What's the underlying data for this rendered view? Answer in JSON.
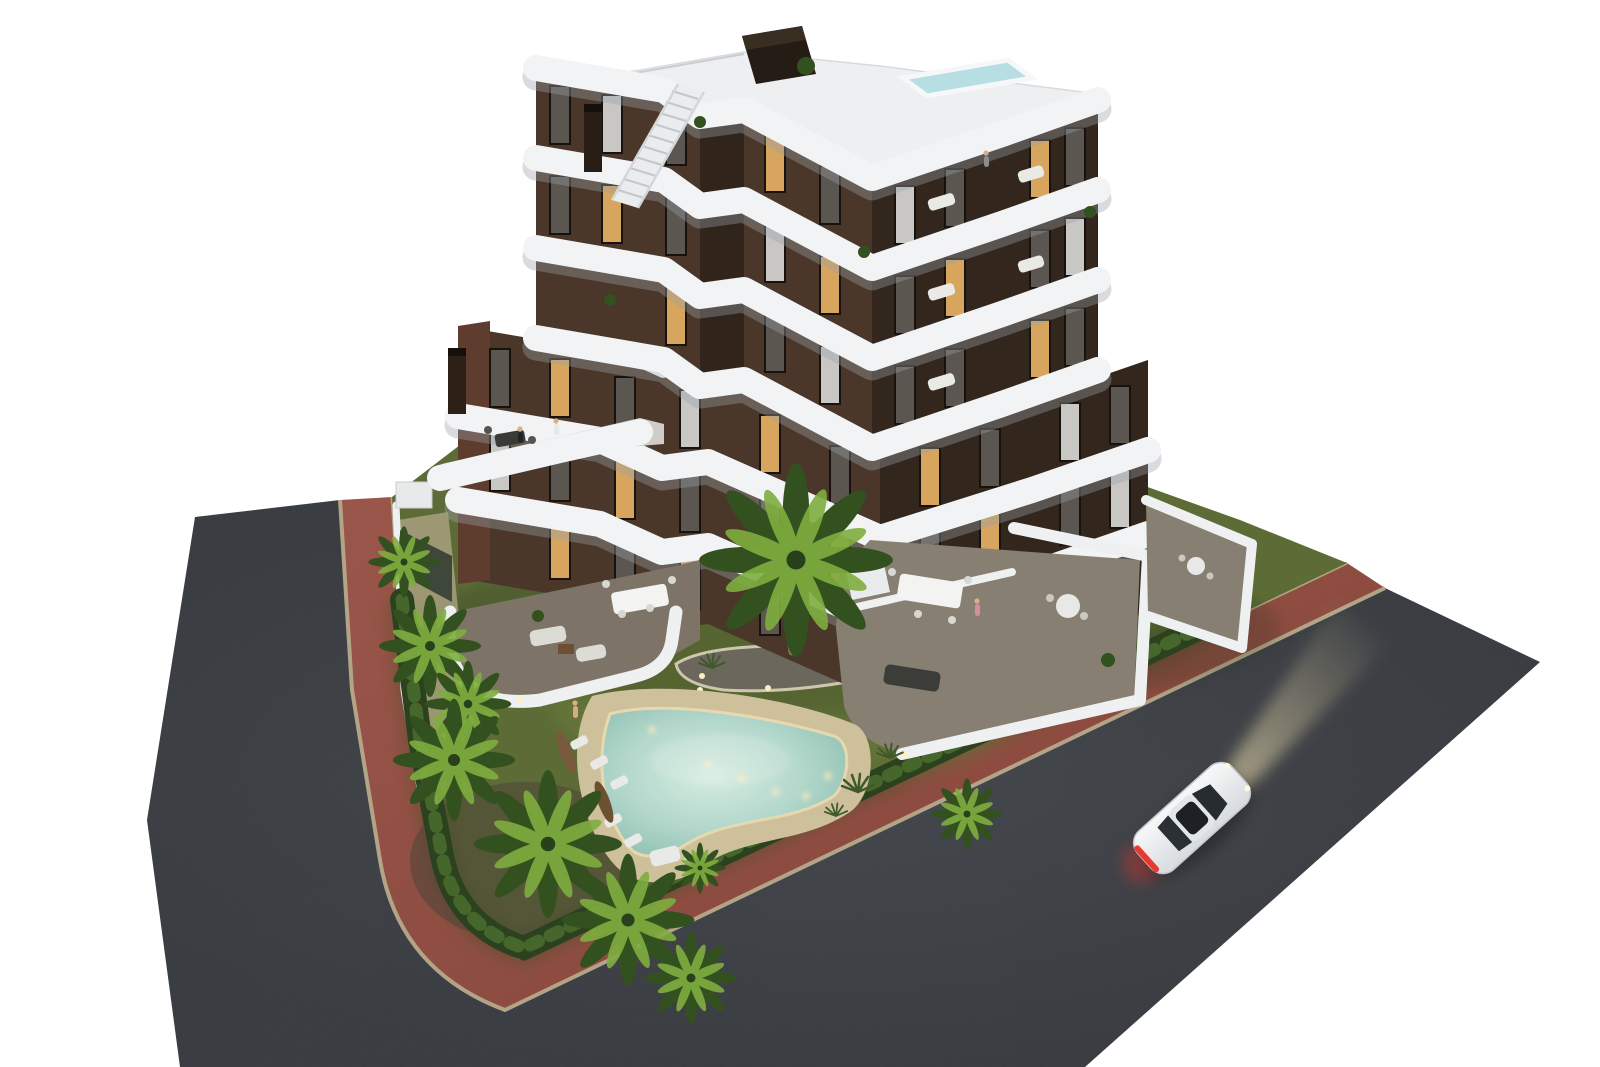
{
  "scene": {
    "title": "Aerial dusk 3D render of a new-build apartment complex with curved white balconies, rooftop pool, palm garden, free-form swimming pool and a white car on the surrounding street",
    "style": "photorealistic architectural visualization isolated on white",
    "view": "aerial three-quarter corner view",
    "time_of_day": "dusk",
    "background": "#ffffff"
  },
  "colors": {
    "bg": "#ffffff",
    "road": "#34373c",
    "road_light": "#474b52",
    "sidewalk": "#955044",
    "sidewalk_dark": "#7a4138",
    "curb": "#b3a488",
    "lawn": "#5d6c36",
    "lawn_dark": "#46552c",
    "hedge": "#2c421f",
    "hedge_light": "#4e7030",
    "gravel": "#b3a58a",
    "mulch": "#4e4639",
    "sand": "#cfc09c",
    "sand_rim": "#e6d9b0",
    "pool_water": "#a9d2c6",
    "pool_water_light": "#d6ece1",
    "pool_light": "#ffefc0",
    "facade_left": "#4a3729",
    "facade_right": "#332820",
    "facade_accent": "#5f3d2e",
    "band_white": "#f2f3f5",
    "roof_white": "#edeff1",
    "roof_pool": "#b7dee2",
    "terrace_floor": "#7d7467",
    "terrace_floor_right": "#878072",
    "wall_white": "#eff0f2",
    "window_glass": "#5b564f",
    "window_lit": "#d8a55e",
    "curtain": "#c9c7c3",
    "furniture_white": "#e9e9e5",
    "furniture_dark": "#3a3a36",
    "wood": "#7a5a3c",
    "umbrella": "#7a5a3c",
    "palm_dark": "#33511f",
    "palm_light": "#7fae3f",
    "trunk": "#8a7358",
    "car_body": "#eef0f2",
    "car_glass": "#272c31",
    "taillight": "#e8392f",
    "beam": "#f2e3b0"
  },
  "counts": {
    "balcony_bands": 6,
    "rooftop_pools": 1,
    "garden_pools": 1,
    "sun_loungers": 6,
    "closed_parasols": 2,
    "palm_trees": 10,
    "cars": 1,
    "people_visible": 5,
    "dining_tables": 3
  },
  "objects": {
    "building": "multi-storey apartment block, dark brown facade with wavy stacked white balcony bands",
    "roof": "white roof terrace with small plunge pool, stair housing and staircase",
    "pool": "free-form lagoon pool with sandy beach deck and underwater lights",
    "car": "white coupe driving with headlights on and red taillights",
    "roads": "dark asphalt streets wrapping the corner plot",
    "sidewalk": "red brick pavement with light curb stones",
    "garden": "lawn with palm trees, hedge border and island planting bed"
  }
}
